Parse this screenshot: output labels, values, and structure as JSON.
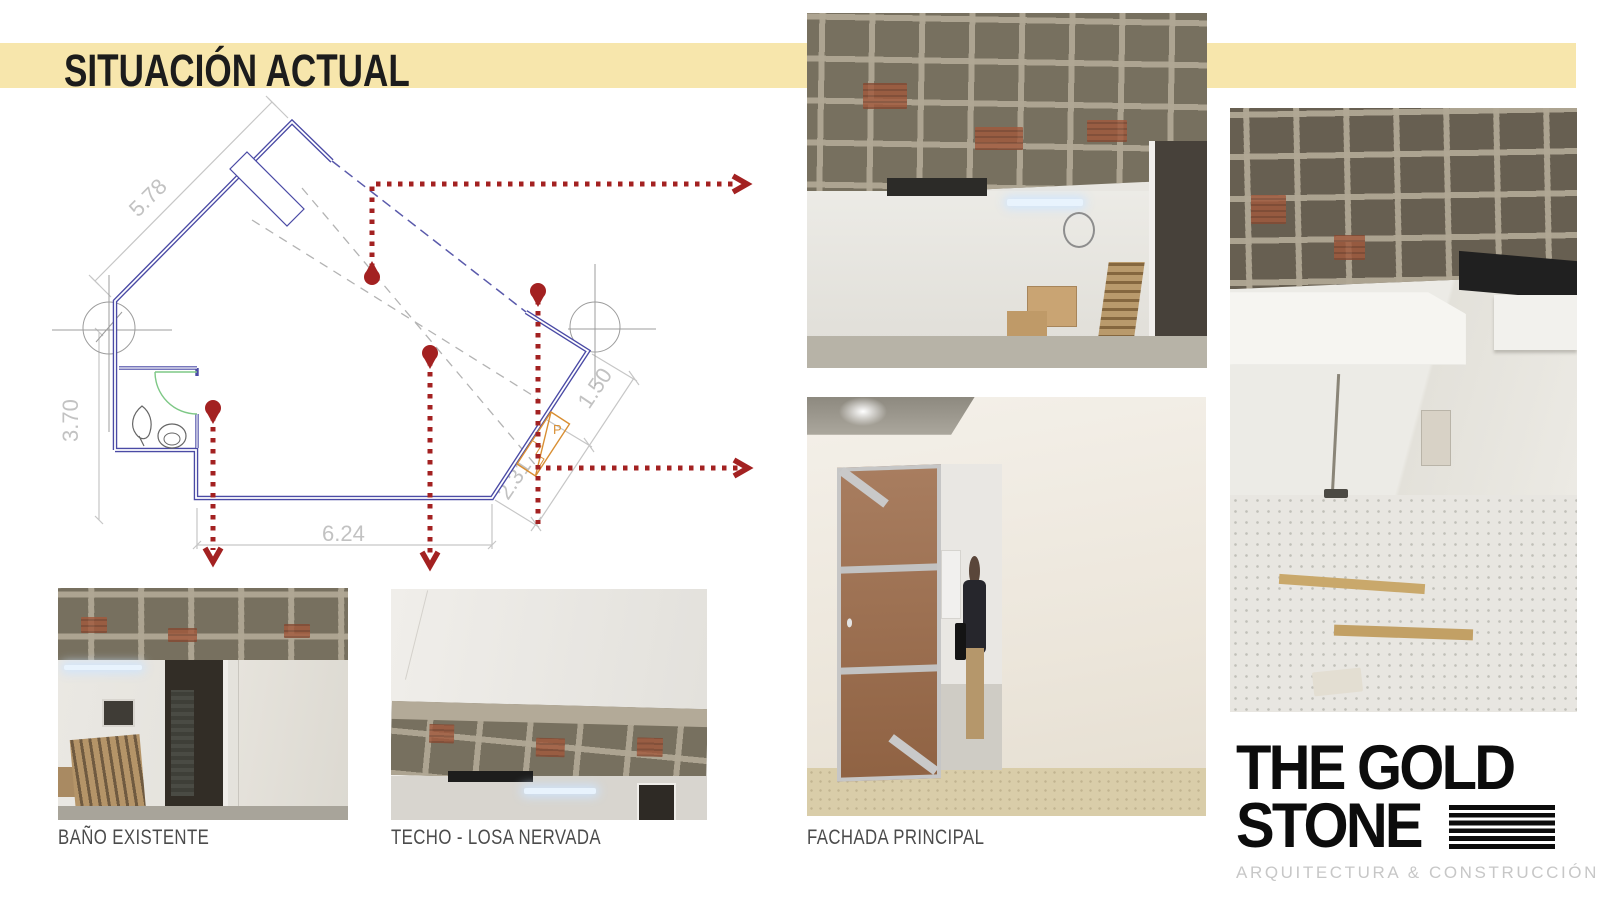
{
  "title": "SITUACIÓN ACTUAL",
  "plan": {
    "dim_top_left": "5.78",
    "dim_left": "3.70",
    "dim_bottom": "6.24",
    "dim_right_upper": "1.50",
    "dim_right_lower": "2.31",
    "door_label": "P"
  },
  "captions": {
    "bano": "BAÑO EXISTENTE",
    "techo": "TECHO - LOSA NERVADA",
    "fachada": "FACHADA PRINCIPAL"
  },
  "logo": {
    "line1": "THE GOLD",
    "line2": "STONE",
    "tagline": "ARQUITECTURA & CONSTRUCCIÓN"
  },
  "colors": {
    "band_yellow": "#f7e6ac",
    "annotation_red": "#a32121",
    "wall_blue": "#4a4aa5",
    "door_orange": "#d98f33",
    "door_green": "#7ec886"
  }
}
